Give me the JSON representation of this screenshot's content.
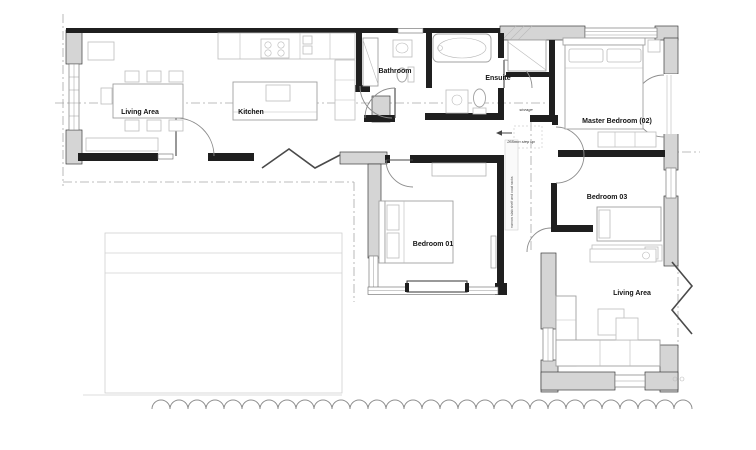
{
  "plan": {
    "type": "architectural-floor-plan",
    "rooms": [
      {
        "id": "living-area-west",
        "label": "Living Area"
      },
      {
        "id": "kitchen",
        "label": "Kitchen"
      },
      {
        "id": "bathroom",
        "label": "Bathroom"
      },
      {
        "id": "ensuite",
        "label": "Ensuite"
      },
      {
        "id": "master-bedroom",
        "label": "Master Bedroom (02)"
      },
      {
        "id": "bedroom-03",
        "label": "Bedroom 03"
      },
      {
        "id": "bedroom-01",
        "label": "Bedroom 01"
      },
      {
        "id": "living-area-east",
        "label": "Living Area"
      }
    ],
    "annotations": [
      {
        "id": "storage-note",
        "text": "storage"
      },
      {
        "id": "step-note",
        "text": "265mm step up"
      },
      {
        "id": "shelf-note",
        "text": "narrow slab shelf and coat racks"
      }
    ],
    "colors": {
      "wall_dark": "#1f1f1f",
      "wall_masonry": "#d5d5d5",
      "furniture_line": "#bdbdbd",
      "dash_line": "#a8a8a8",
      "background": "#ffffff",
      "text": "#141414"
    }
  }
}
